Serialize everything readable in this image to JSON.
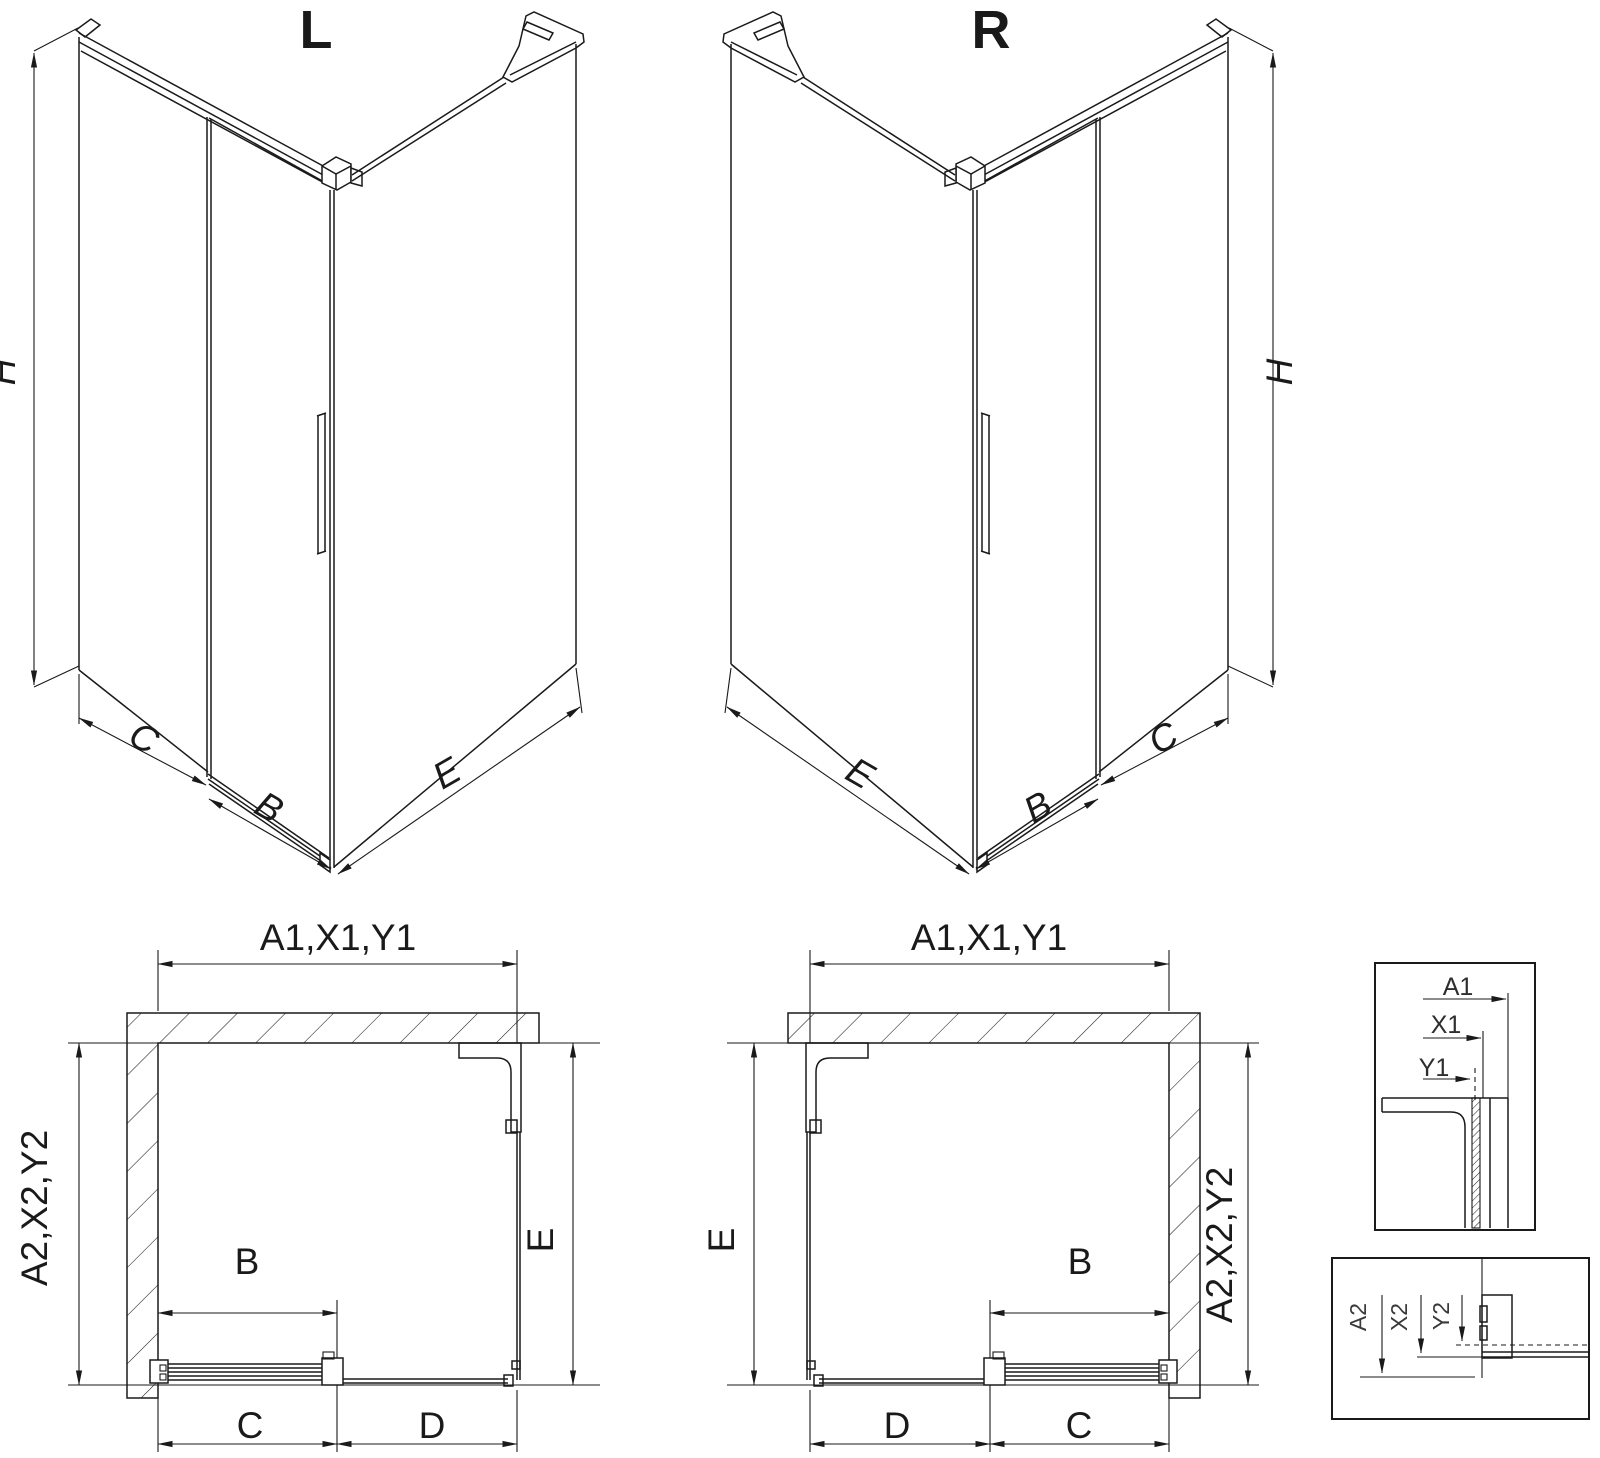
{
  "drawing": {
    "background": "#ffffff",
    "line_color": "#1a1a1a",
    "views": {
      "iso_left": {
        "title": "L",
        "dim_height": "H",
        "dim_side": "C",
        "dim_door": "B",
        "dim_panel": "E"
      },
      "iso_right": {
        "title": "R",
        "dim_height": "H",
        "dim_panel": "E",
        "dim_door": "B",
        "dim_side": "C"
      },
      "plan_left": {
        "dim_top": "A1,X1,Y1",
        "dim_left": "A2,X2,Y2",
        "dim_right": "E",
        "dim_door": "B",
        "dim_bottom_left": "C",
        "dim_bottom_right": "D"
      },
      "plan_right": {
        "dim_top": "A1,X1,Y1",
        "dim_left": "E",
        "dim_right": "A2,X2,Y2",
        "dim_door": "B",
        "dim_bottom_left": "D",
        "dim_bottom_right": "C"
      },
      "detail_top": {
        "dim_a": "A1",
        "dim_x": "X1",
        "dim_y": "Y1"
      },
      "detail_bottom": {
        "dim_a": "A2",
        "dim_x": "X2",
        "dim_y": "Y2"
      }
    }
  }
}
